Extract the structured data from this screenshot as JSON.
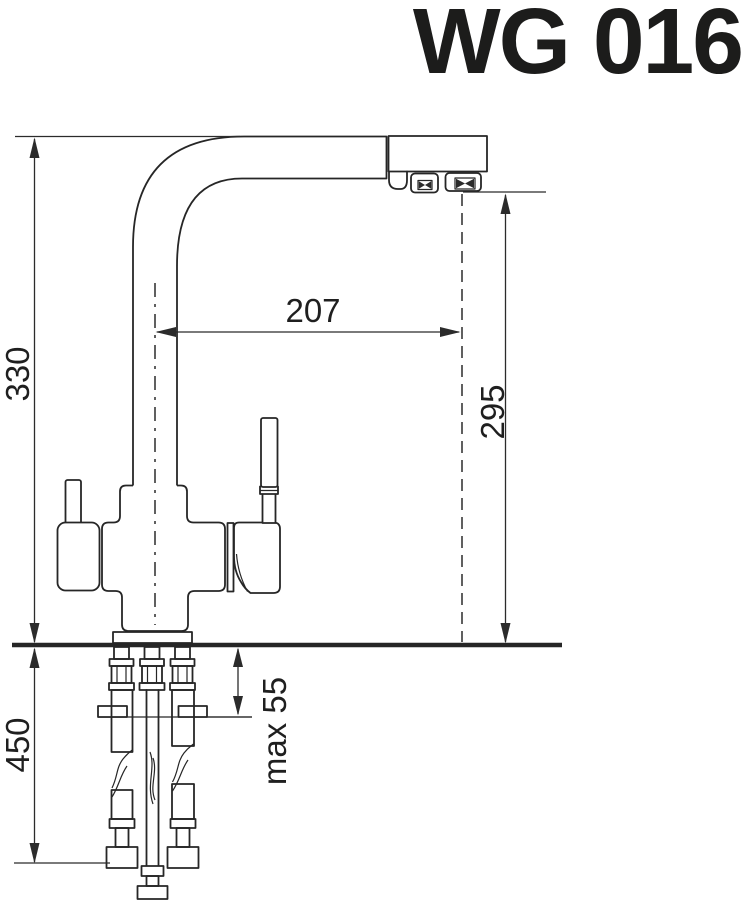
{
  "title": "WG 016",
  "diagram": {
    "subject": "Kitchen faucet dimensional drawing, side view with under-counter mounting hardware and supply hoses",
    "dimensions": {
      "d330": "330",
      "d207": "207",
      "d295": "295",
      "d450": "450",
      "dmax55": "max 55"
    },
    "colors": {
      "line": "#262626",
      "title": "#1c1c1b",
      "background": "#ffffff"
    }
  }
}
